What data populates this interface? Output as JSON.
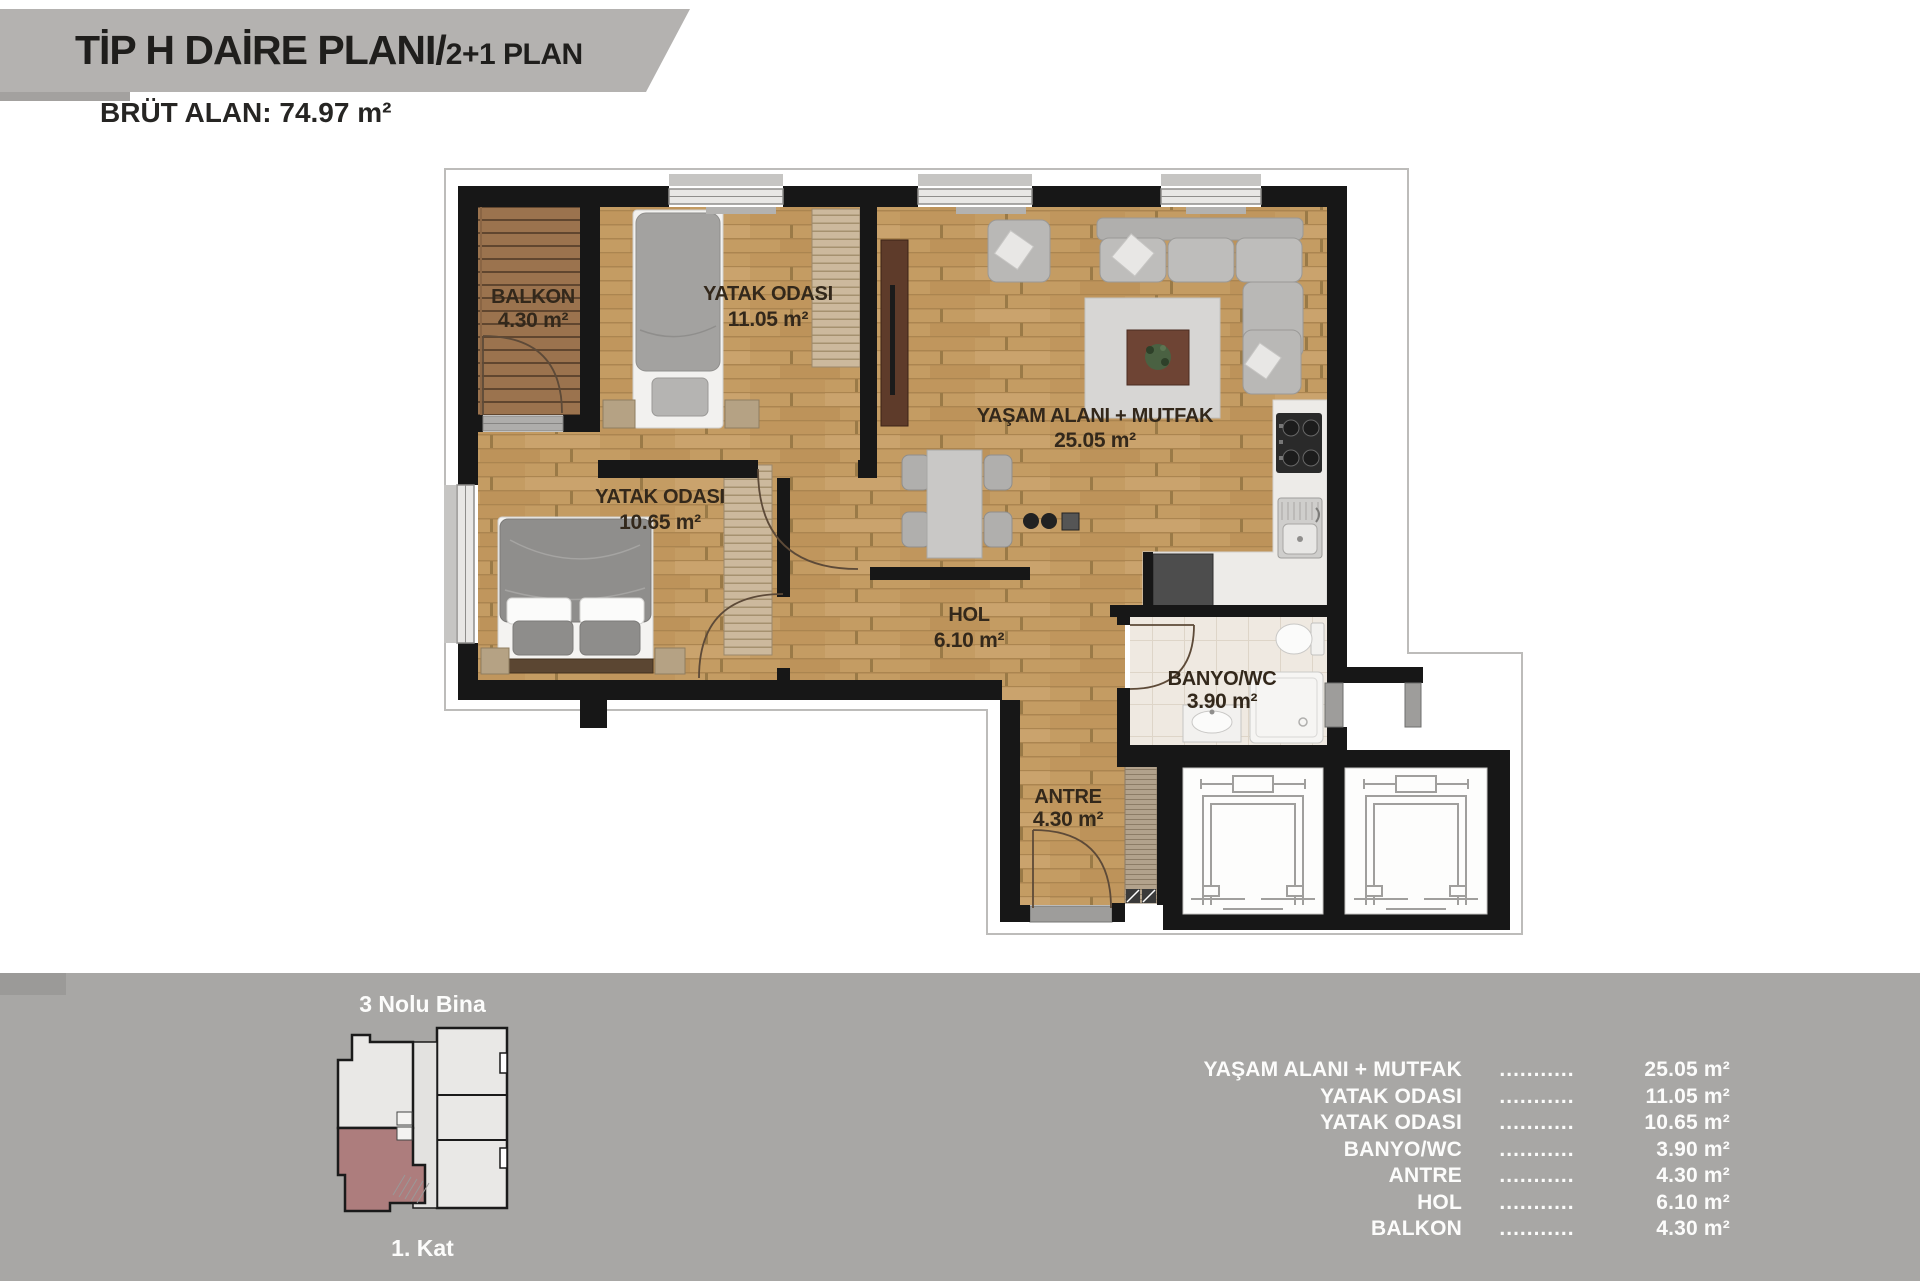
{
  "header": {
    "title_main": "TİP H DAİRE PLANI/",
    "title_sub": "2+1 PLAN",
    "gross_area": "BRÜT ALAN: 74.97 m²"
  },
  "plan": {
    "rooms": {
      "balkon": {
        "name": "BALKON",
        "area": "4.30 m²"
      },
      "yatak1": {
        "name": "YATAK ODASI",
        "area": "11.05 m²"
      },
      "yatak2": {
        "name": "YATAK ODASI",
        "area": "10.65 m²"
      },
      "yasam": {
        "name": "YAŞAM ALANI + MUTFAK",
        "area": "25.05 m²"
      },
      "hol": {
        "name": "HOL",
        "area": "6.10 m²"
      },
      "banyo": {
        "name": "BANYO/WC",
        "area": "3.90 m²"
      },
      "antre": {
        "name": "ANTRE",
        "area": "4.30 m²"
      }
    }
  },
  "footer": {
    "building": "3 Nolu Bina",
    "floor": "1. Kat",
    "dots": "...........",
    "items": [
      {
        "label": "YAŞAM ALANI + MUTFAK",
        "value": "25.05 m²"
      },
      {
        "label": "YATAK ODASI",
        "value": "11.05 m²"
      },
      {
        "label": "YATAK ODASI",
        "value": "10.65 m²"
      },
      {
        "label": "BANYO/WC",
        "value": "3.90 m²"
      },
      {
        "label": "ANTRE",
        "value": "4.30 m²"
      },
      {
        "label": "HOL",
        "value": "6.10 m²"
      },
      {
        "label": "BALKON",
        "value": "4.30 m²"
      }
    ]
  },
  "colors": {
    "highlight_unit": "#ad7d7d",
    "wood_floor": "#c49c63",
    "balcony_wood": "#9b734e",
    "wall": "#171717",
    "banner_bg": "#b4b2b0",
    "footer_bg": "#a8a7a5",
    "label_text": "#33281b"
  }
}
